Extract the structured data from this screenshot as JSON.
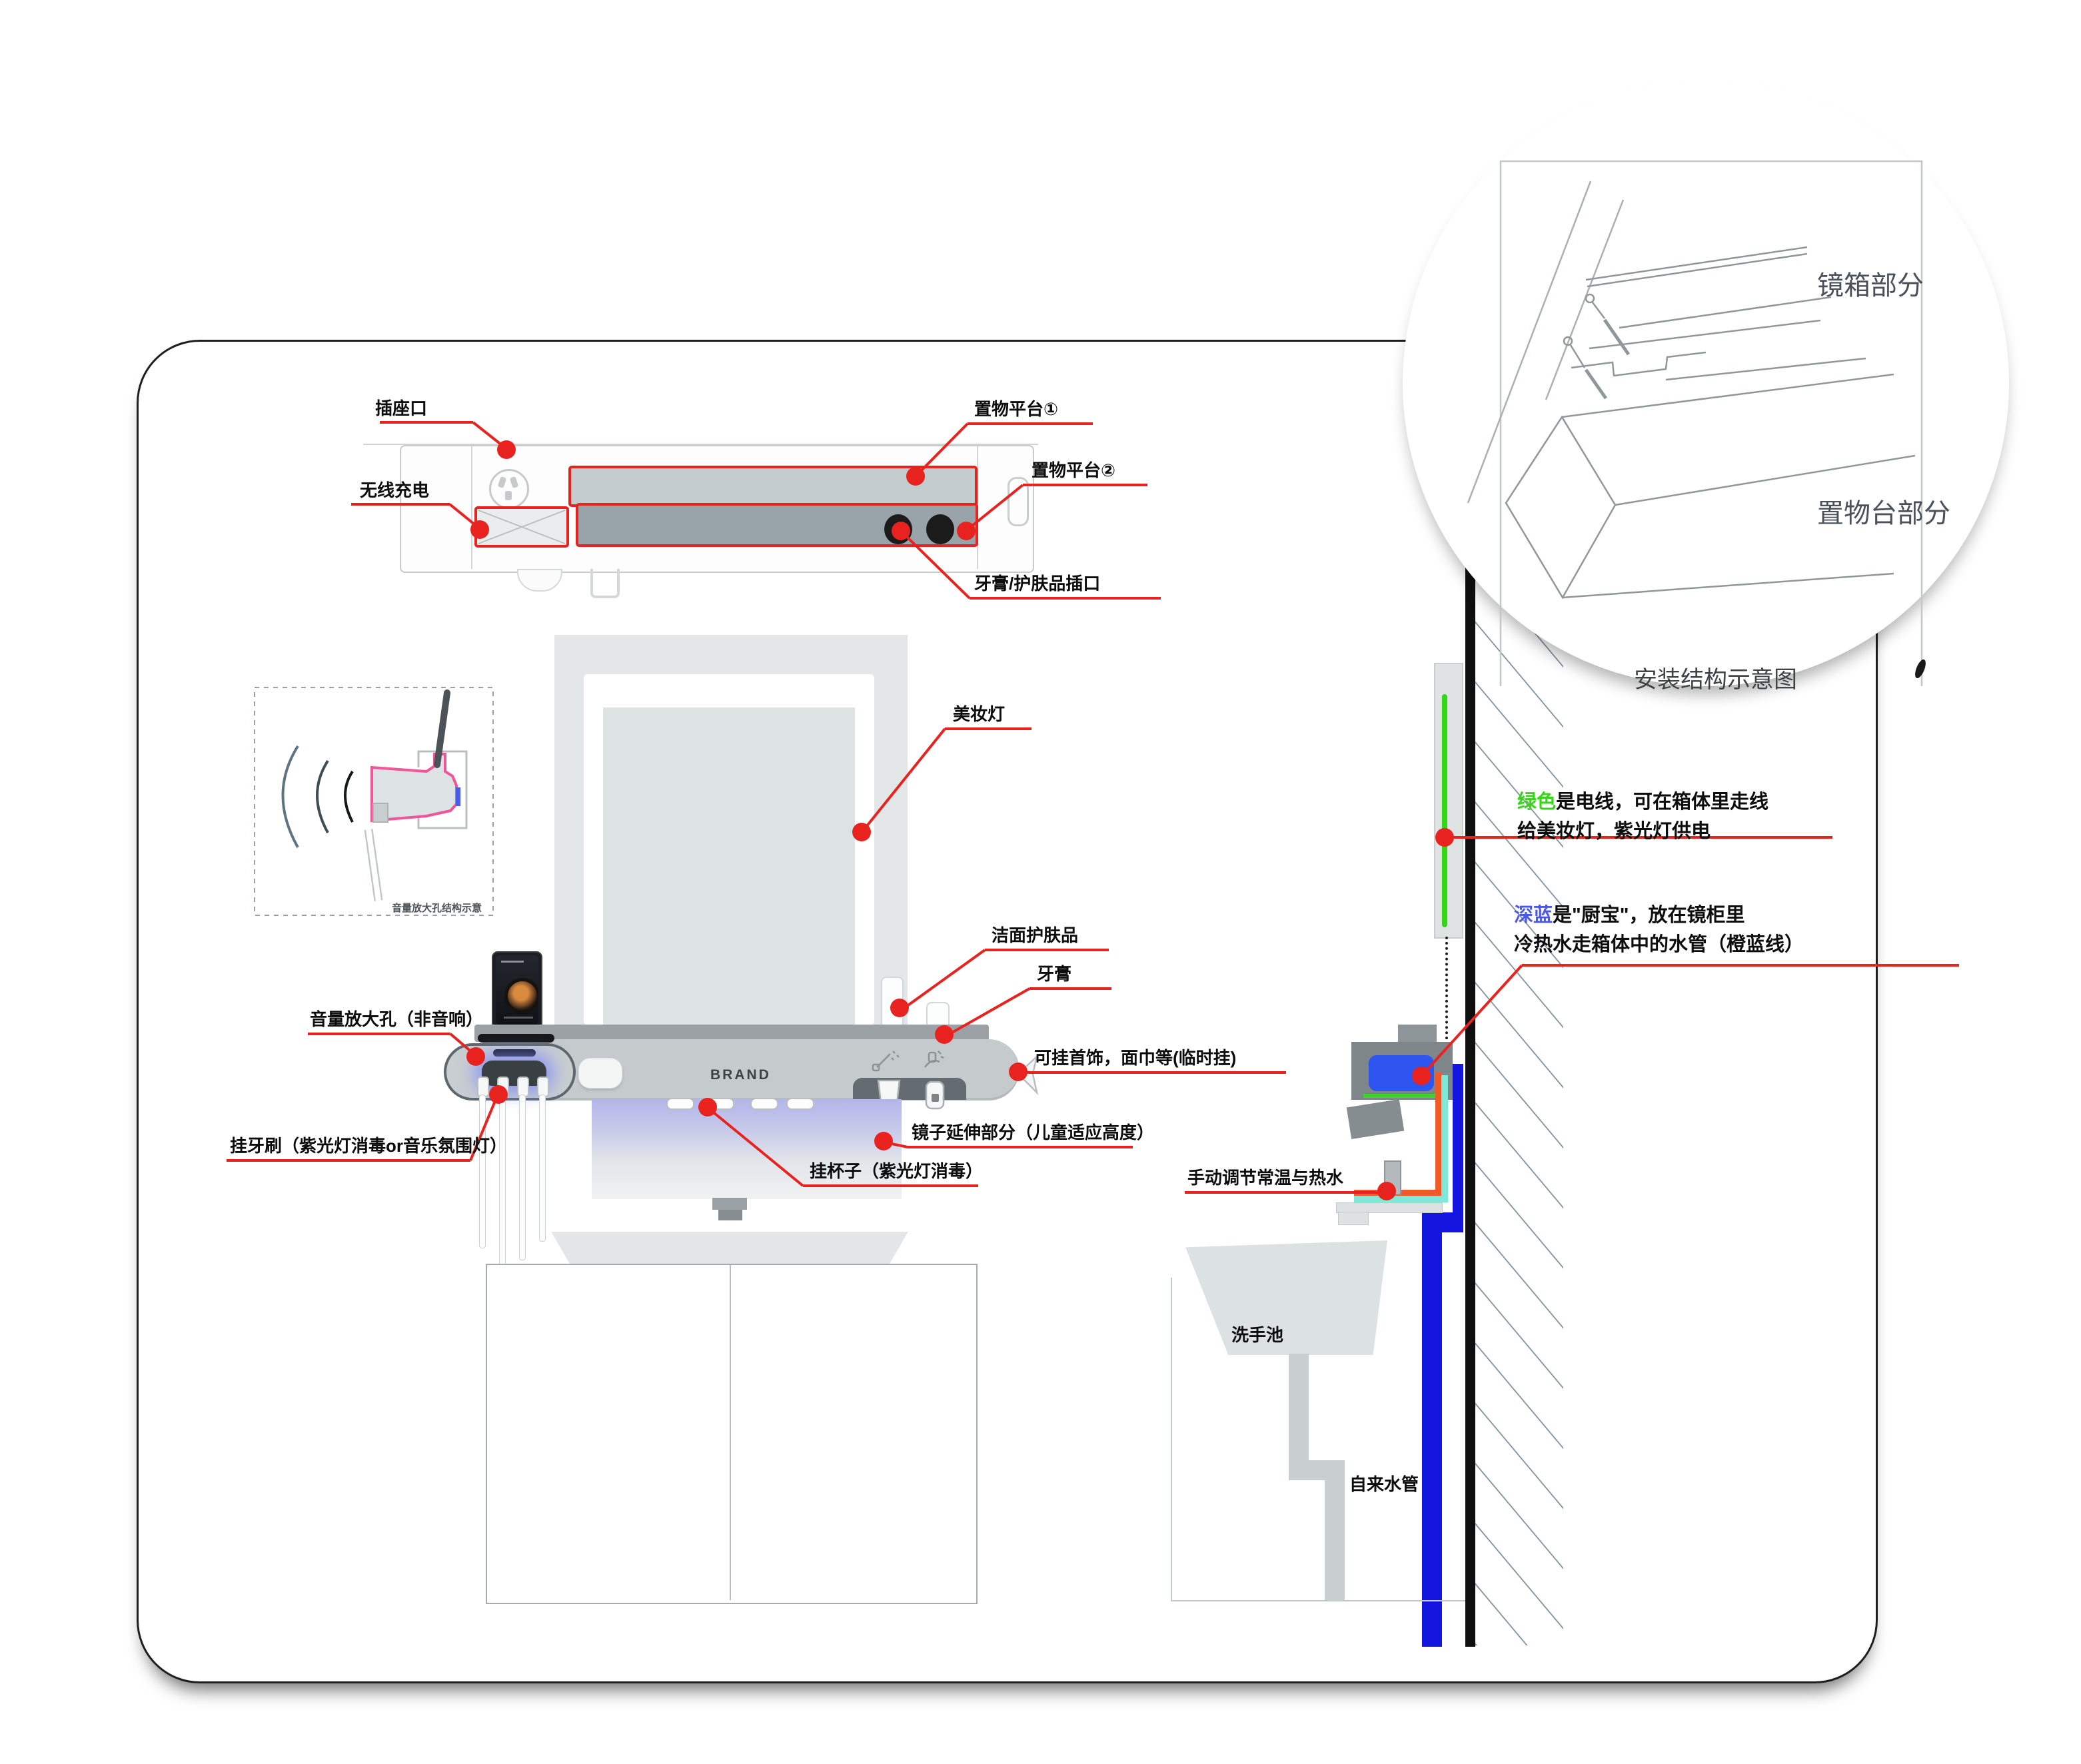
{
  "colors": {
    "accent_red": "#e8231f",
    "wire_green": "#35d518",
    "deep_blue_word": "#4a58e8",
    "pipe_blue": "#1515e0",
    "pipe_orange": "#f05a28",
    "pipe_cyan": "#7fe8d8",
    "heater_blue": "#2f55f0",
    "uv_glow_purple": "#8a96fa"
  },
  "top_view": {
    "socket_label": "插座口",
    "wireless_label": "无线充电",
    "platform1_label": "置物平台①",
    "platform2_label": "置物平台②",
    "paste_slot_label": "牙膏/护肤品插口"
  },
  "front_view": {
    "brand": "BRAND",
    "makeup_light_label": "美妆灯",
    "cleanser_label": "洁面护肤品",
    "toothpaste_label": "牙膏",
    "hang_items_label": "可挂首饰，面巾等(临时挂)",
    "mirror_extension_label": "镜子延伸部分（儿童适应高度）",
    "hang_cup_label": "挂杯子（紫光灯消毒）",
    "volume_hole_label": "音量放大孔（非音响）",
    "hang_toothbrush_label": "挂牙刷（紫光灯消毒or音乐氛围灯）"
  },
  "side_view": {
    "wire_note_colored": "绿色",
    "wire_note_line1": "是电线，可在箱体里走线",
    "wire_note_line2": "给美妆灯，紫光灯供电",
    "heater_note_colored": "深蓝",
    "heater_note_line1": "是\"厨宝\"，放在镜柜里",
    "heater_note_line2": "冷热水走箱体中的水管（橙蓝线）",
    "valve_label": "手动调节常温与热水",
    "sink_label": "洗手池",
    "water_pipe_label": "自来水管"
  },
  "inset_circle": {
    "mirror_box_label": "镜箱部分",
    "shelf_part_label": "置物台部分",
    "caption": "安装结构示意图"
  },
  "volume_inset": {
    "caption": "音量放大孔结构示意"
  }
}
